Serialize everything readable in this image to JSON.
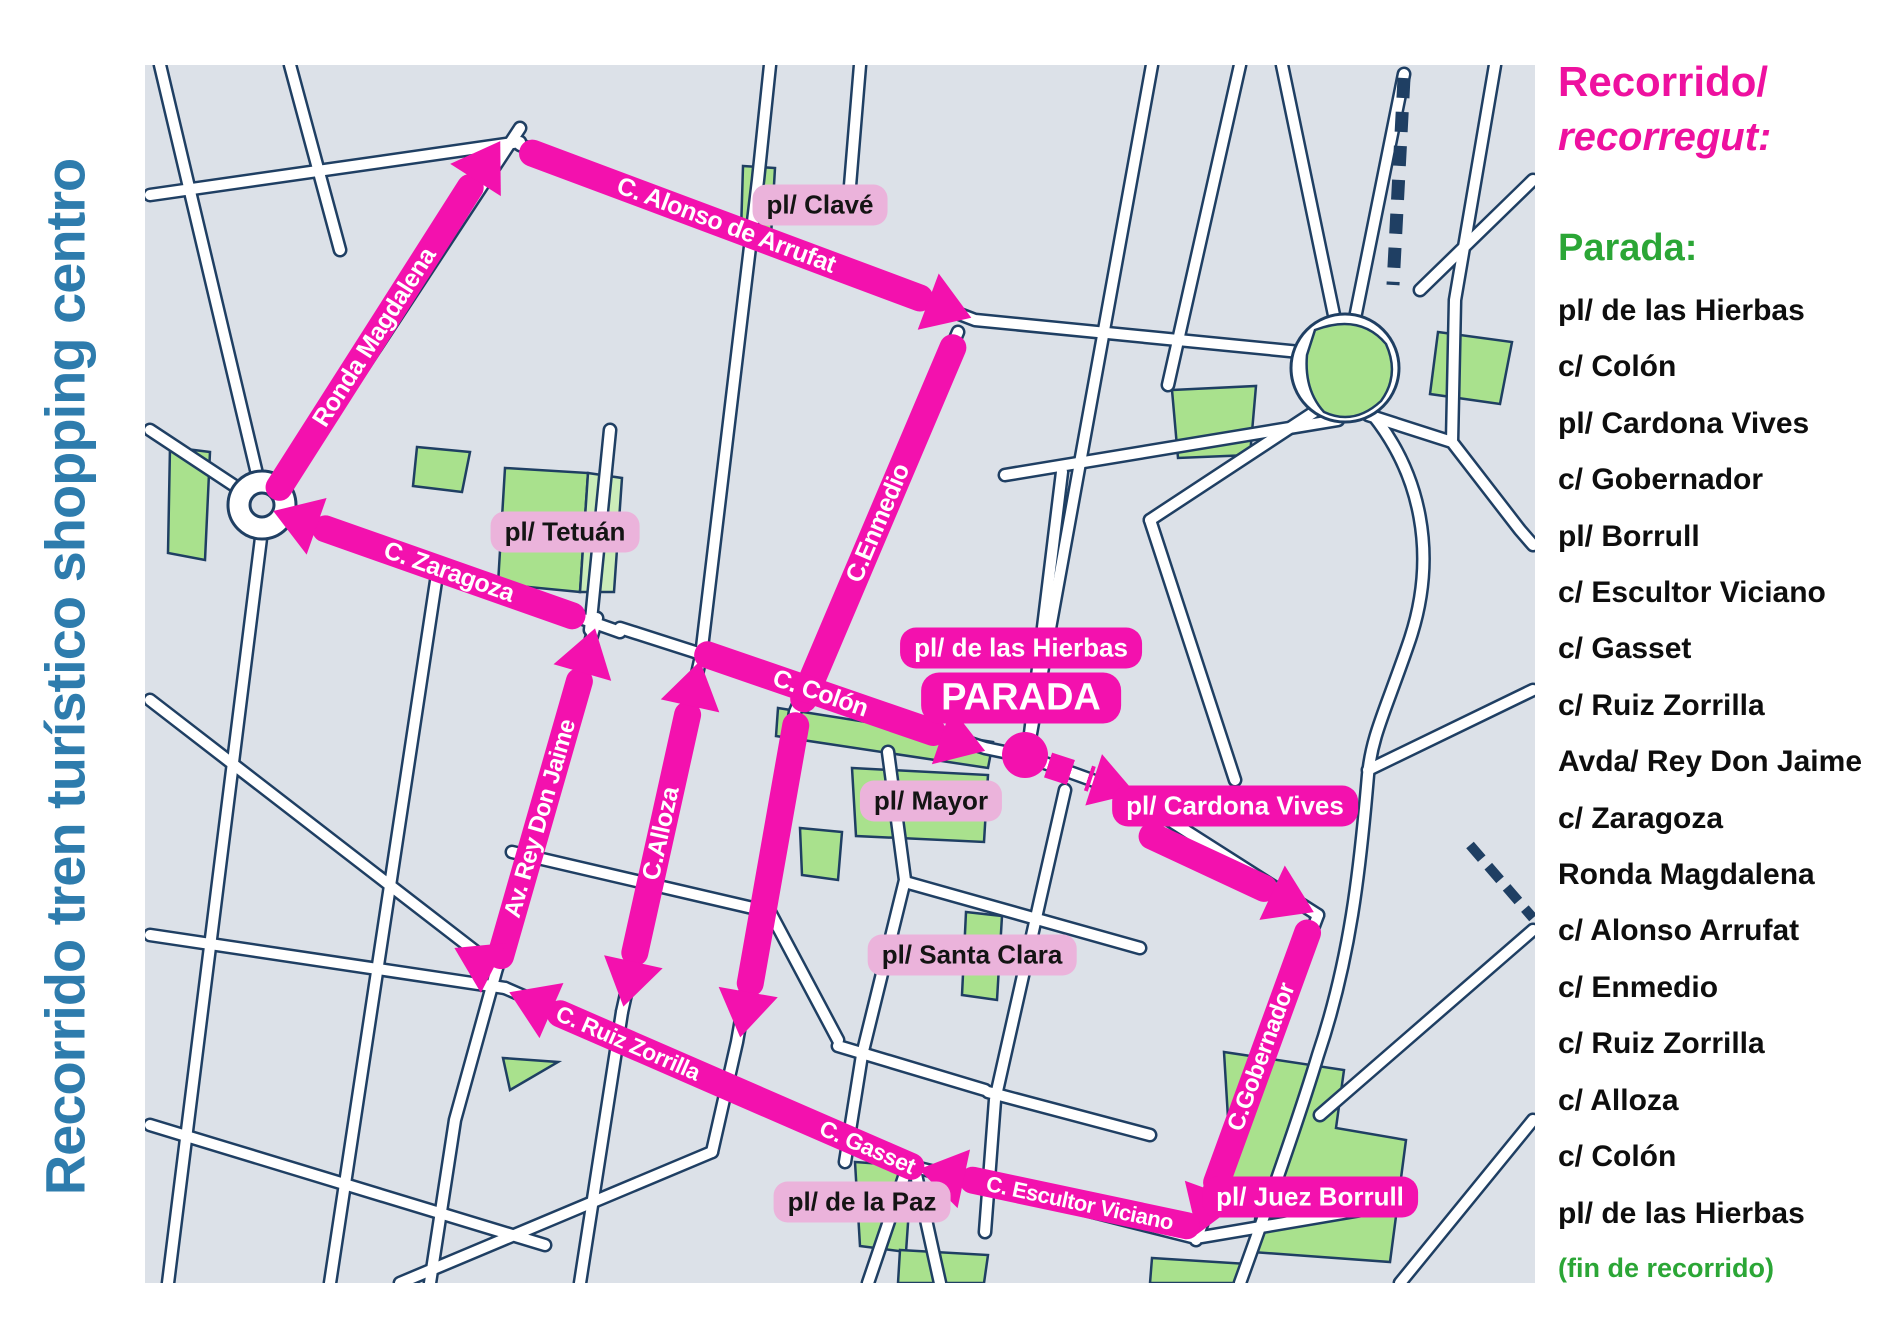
{
  "title": "Recorrido tren turístico shopping centro",
  "sidebar": {
    "route_heading": "Recorrido/",
    "route_heading_catalan": "recorregut:",
    "stops_heading": "Parada:",
    "stops": [
      "pl/ de las Hierbas",
      "c/ Colón",
      "pl/ Cardona Vives",
      "c/ Gobernador",
      "pl/ Borrull",
      "c/ Escultor Viciano",
      "c/ Gasset",
      "c/ Ruiz Zorrilla",
      "Avda/ Rey Don Jaime",
      "c/ Zaragoza",
      "Ronda Magdalena",
      "c/ Alonso Arrufat",
      "c/ Enmedio",
      "c/ Ruiz Zorrilla",
      "c/ Alloza",
      "c/ Colón",
      "pl/ de las Hierbas"
    ],
    "end_note": "(fin de recorrido)"
  },
  "map": {
    "streets": {
      "ronda_magdalena": "Ronda Magdalena",
      "alonso_arrufat": "C. Alonso de Arrufat",
      "enmedio": "C.Enmedio",
      "colon": "C. Colón",
      "alloza": "C.Alloza",
      "rey_don_jaime": "Av. Rey Don Jaime",
      "zaragoza": "C. Zaragoza",
      "ruiz_zorrilla": "C. Ruiz Zorrilla",
      "gasset": "C. Gasset",
      "gobernador": "C.Gobernador",
      "escultor_viciano": "C. Escultor Viciano"
    },
    "plazas": {
      "clave": "pl/ Clavé",
      "tetuan": "pl/ Tetuán",
      "mayor": "pl/ Mayor",
      "santa_clara": "pl/ Santa Clara",
      "de_la_paz": "pl/ de la Paz"
    },
    "stop_badges": {
      "hierbas": "pl/ de las Hierbas",
      "parada": "PARADA",
      "cardona_vives": "pl/ Cardona Vives",
      "juez_borrull": "pl/ Juez Borrull"
    }
  },
  "colors": {
    "route_magenta": "#F311AE",
    "badge_pink": "#EBB3DB",
    "title_blue": "#2E7CAD",
    "heading_magenta": "#EE119F",
    "green": "#2BA636",
    "map_background": "#DCE1E8",
    "street_casing": "#1F3F63",
    "park_green": "#A9E18D"
  }
}
